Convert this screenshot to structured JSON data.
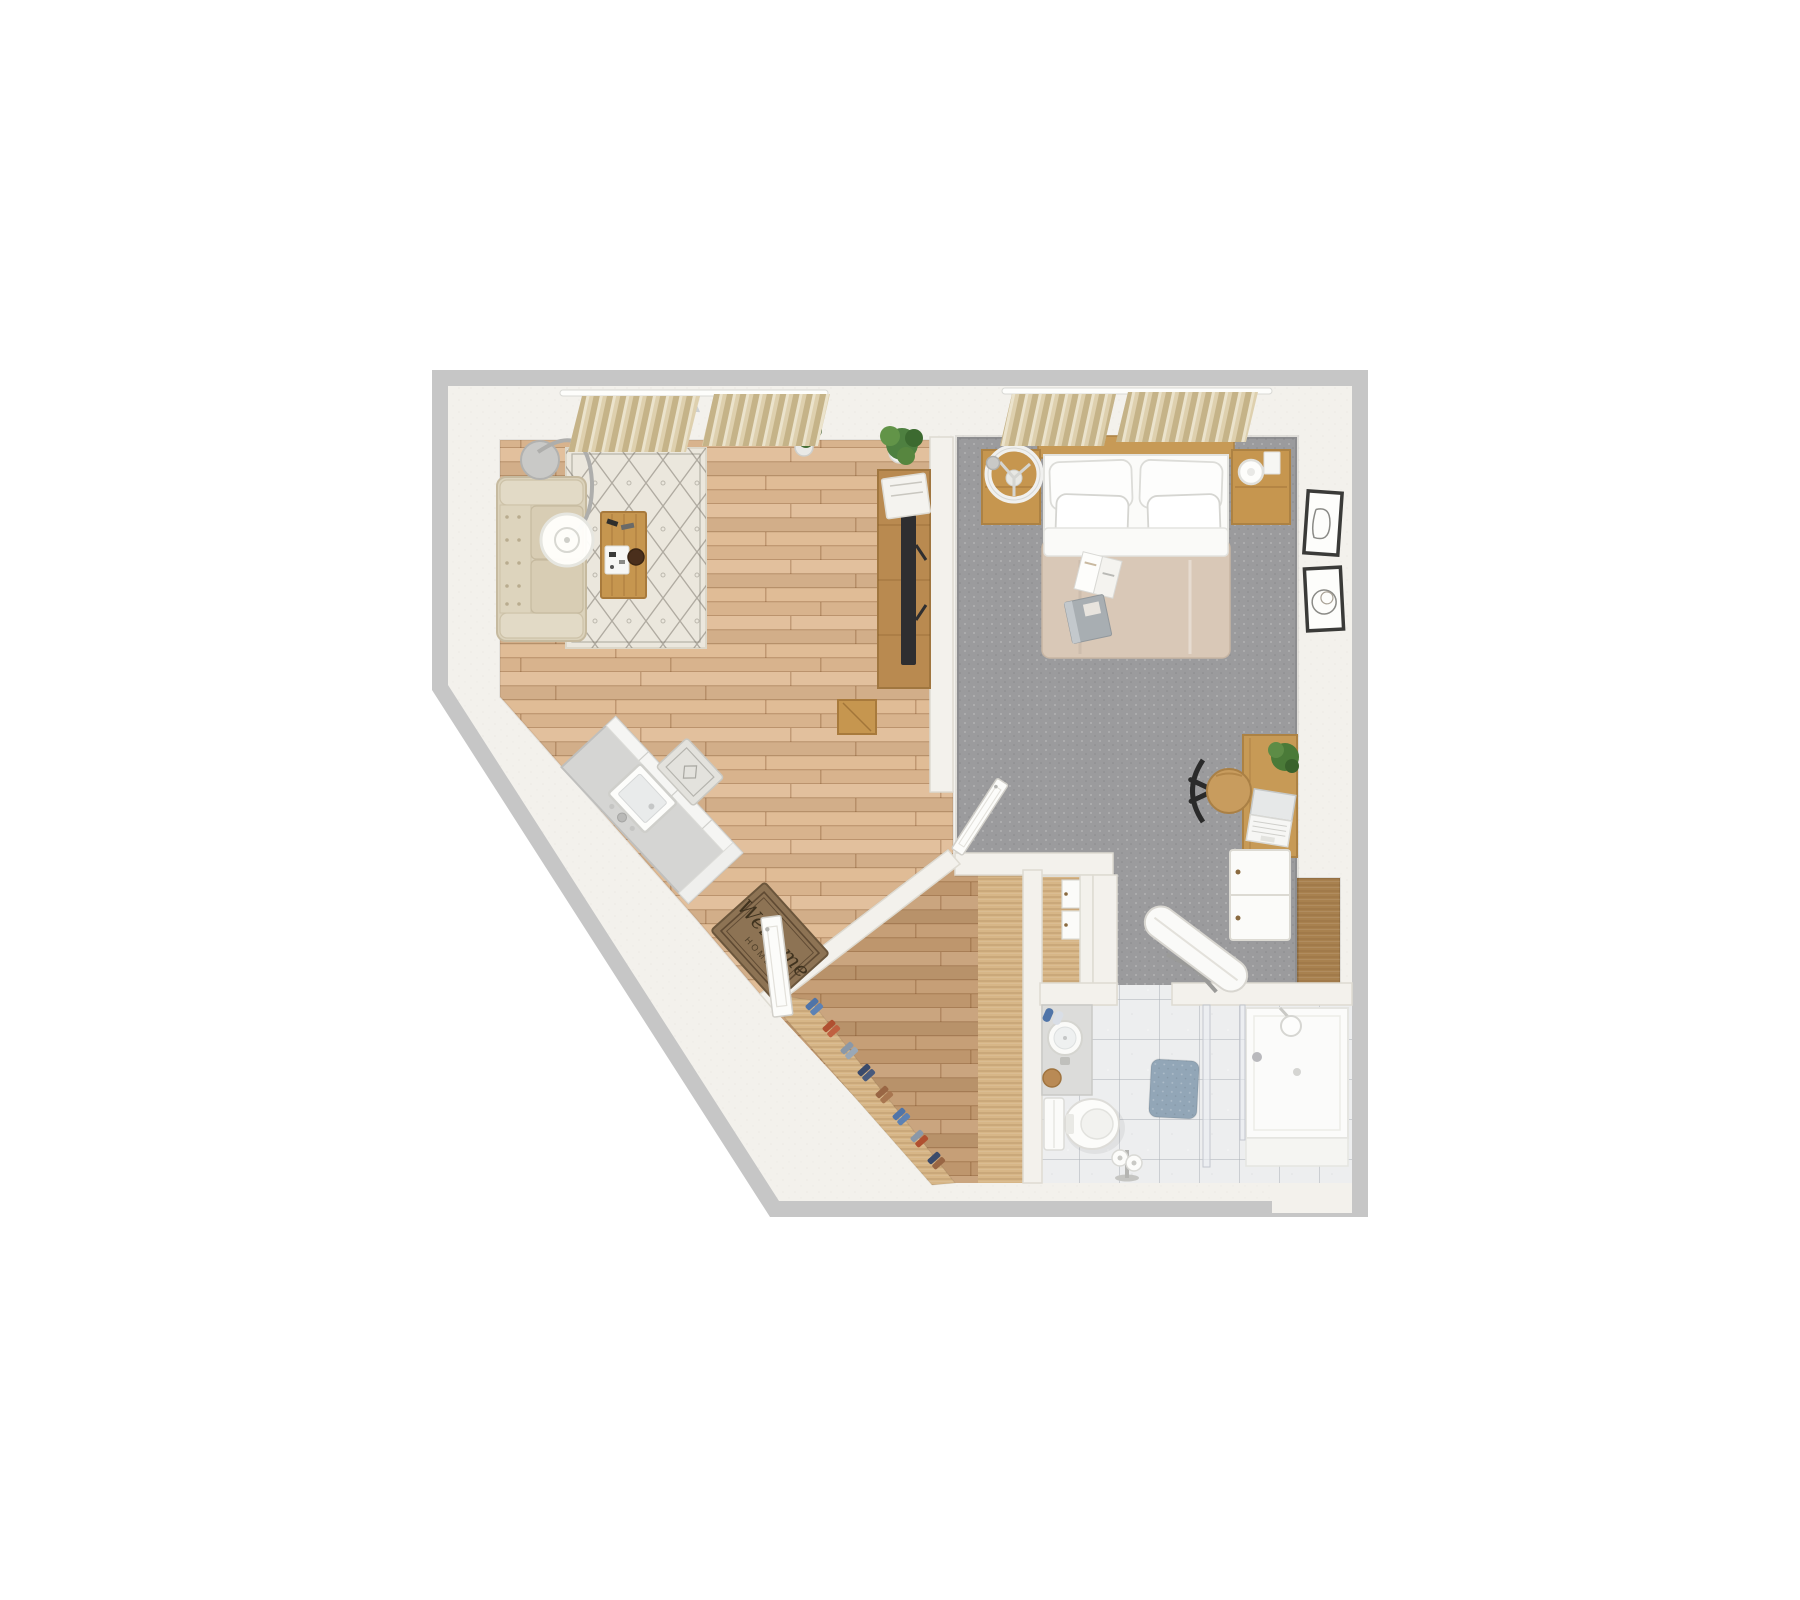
{
  "scene": {
    "kind": "3d-rendered apartment floor plan, top-down view",
    "canvas": {
      "width": 1800,
      "height": 1600
    },
    "rooms_depicted": [
      "living-room",
      "bedroom",
      "kitchen",
      "entry",
      "closet-hall",
      "bathroom"
    ]
  },
  "entry_mat": {
    "line1": "Welcome",
    "line2": "HOME"
  },
  "colors": {
    "background": "#ffffff",
    "outer_wall": "#c6c6c6",
    "inner_wall": "#f3f1ec",
    "wood_living": "#dfb992",
    "wood_hall": "#c49b71",
    "wood_closet": "#d7b687",
    "wood_niche": "#a8814f",
    "carpet": "#9b9b9d",
    "tile": "#edeeef",
    "rug": "#ebe7dd",
    "sofa": "#dbd2bb",
    "cushion": "#d8cdb4",
    "curtain": "#ded0ae",
    "island": "#d5d5d3",
    "wood_furniture": "#c6964f",
    "headboard": "#c79a56",
    "duvet": "#d9c8b7",
    "bed_linen": "#fbfbf9",
    "welcome_mat": "#8d7354",
    "bath_mat": "#92a6b7",
    "plant_dark": "#3f6b33",
    "plant_light": "#4e8040",
    "tv": "#2e2e30",
    "white_goods": "#fbfbf9",
    "shoe_blue": "#4f74a8",
    "shoe_red": "#b05030",
    "shoe_navy": "#3a4a6b",
    "shoe_gray": "#8a98a8",
    "shoe_brown": "#996644"
  }
}
